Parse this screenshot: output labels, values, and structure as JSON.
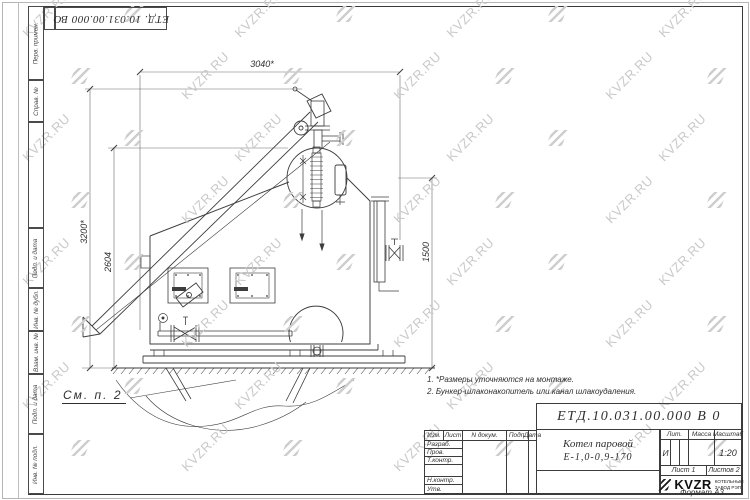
{
  "corner": {
    "designation": "ЕТД. 10.031.00.000  ВО"
  },
  "margin": {
    "items": [
      "Перв. примен.",
      "Справ. №",
      "Подп. и дата",
      "Инв. № дубл.",
      "Взам. инв. №",
      "Подп. и дата",
      "Инв. № подл."
    ]
  },
  "watermark": {
    "text": "KVZR.RU"
  },
  "dims": {
    "top": "3040*",
    "height_outer": "3200*",
    "height_inner": "2604",
    "right": "1500"
  },
  "drawing": {
    "see_note": "См. п. 2"
  },
  "notes": {
    "line1": "1.  *Размеры уточняются на монтаже.",
    "line2": "2.  Бункер-шлаконакопитель или канал шлакоудаления."
  },
  "tb": {
    "designation": "ЕТД.10.031.00.000  В 0",
    "name1": "Котел паровой",
    "name2": "Е-1,0-0,9-170",
    "col_izm": "Изм.",
    "col_list": "Лист",
    "col_doc": "N докум.",
    "col_sign": "Подп.",
    "col_date": "Дата",
    "row_razrab": "Разраб.",
    "row_prov": "Пров.",
    "row_tkontr": "Т.контр.",
    "row_nkontr": "Н.контр.",
    "row_utv": "Утв.",
    "lit_label": "Лит.",
    "lit_value": "И",
    "massa_label": "Масса",
    "scale_label": "Масштаб",
    "scale_value": "1:20",
    "sheet": "Лист 1",
    "sheets": "Листов 2",
    "logo": "KVZR",
    "logo_sub1": "КОТЕЛЬНЫЙ",
    "logo_sub2": "ЗАВОД РЭП",
    "format": "Формат А3"
  }
}
